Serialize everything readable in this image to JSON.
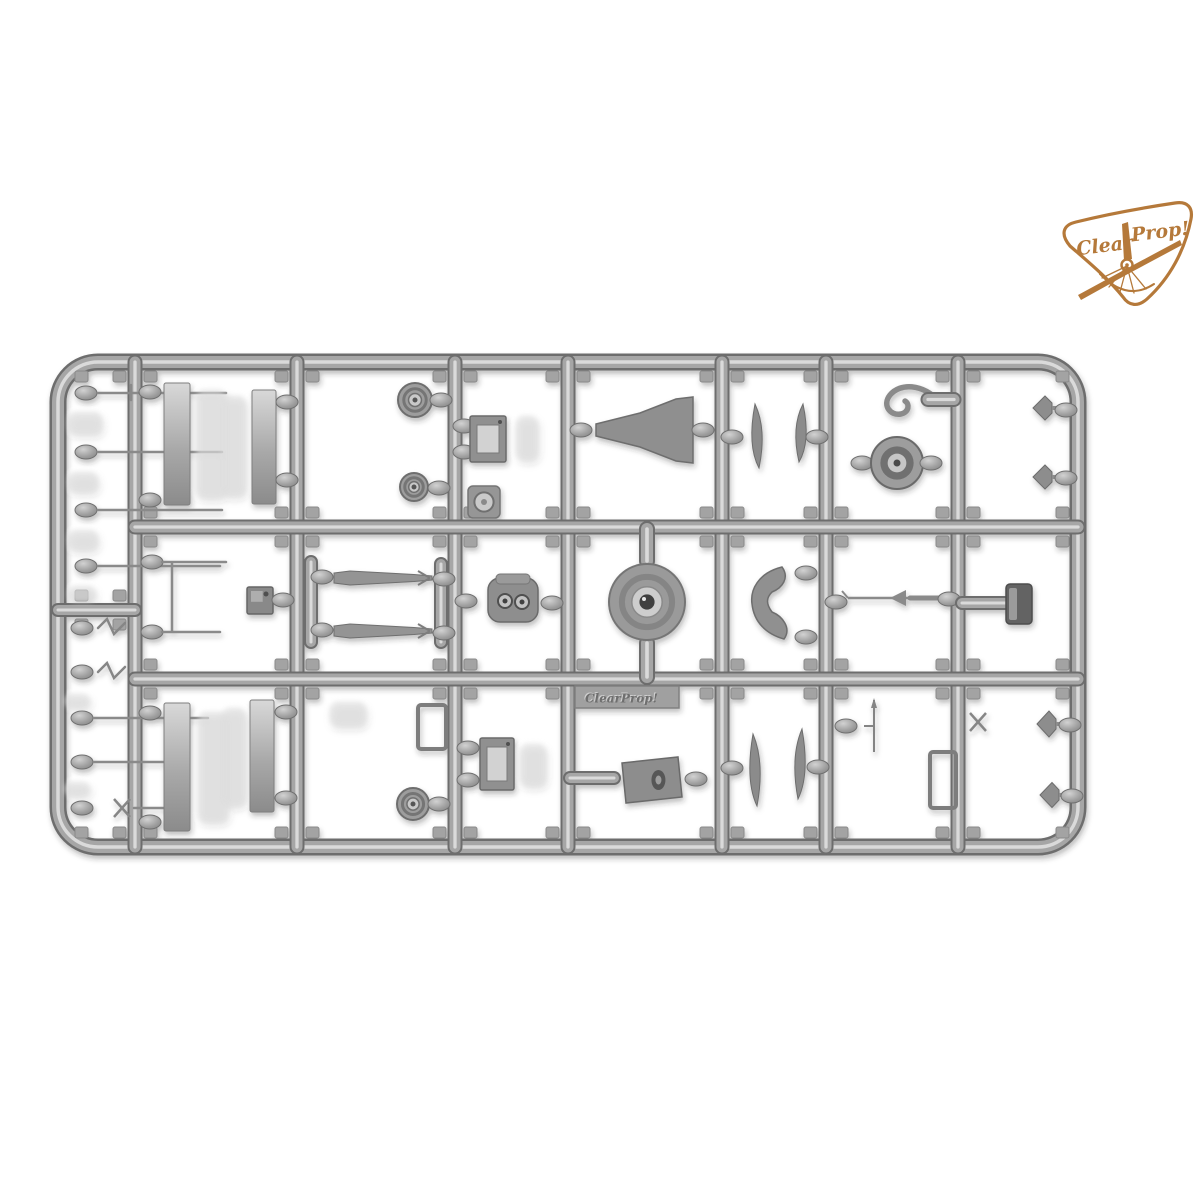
{
  "meta": {
    "background": "#ffffff",
    "description": "product photo of a gray plastic model-kit sprue with small parts, Clear Prop logo top right"
  },
  "logo": {
    "text_left": "Clear",
    "text_right": "Prop!",
    "color": "#b5793a"
  },
  "nameplate": {
    "text": "ClearProp!"
  },
  "palette": {
    "rail_dark": "#6d6d6d",
    "rail_mid": "#a6a6a6",
    "rail_light": "#dadada",
    "part_dark": "#757575",
    "part_mid": "#9a9a9a",
    "part_light": "#cccccc",
    "ghost": "#dedede",
    "tab_fill": "#a3a3a3",
    "tab_stroke": "#8a8a8a"
  },
  "sprue": {
    "frame": {
      "x1": 58,
      "y1": 362,
      "x2": 1078,
      "y2": 847,
      "r": 40
    },
    "v_rails": [
      135,
      297,
      455,
      568,
      722,
      826,
      958
    ],
    "h_rails": [
      527,
      679
    ],
    "strip_divider_y": 610,
    "cols": [
      [
        135,
        297
      ],
      [
        297,
        455
      ],
      [
        455,
        568
      ],
      [
        568,
        722
      ],
      [
        722,
        826
      ],
      [
        826,
        958
      ],
      [
        958,
        1078
      ]
    ],
    "rows": [
      [
        362,
        527
      ],
      [
        527,
        679
      ],
      [
        679,
        847
      ]
    ],
    "strip_col": [
      66,
      135
    ],
    "strip_rows": [
      [
        362,
        610
      ],
      [
        610,
        847
      ]
    ],
    "parts": [
      {
        "t": "gate",
        "x": 86,
        "y": 393
      },
      {
        "t": "pin",
        "x1": 98,
        "y1": 393,
        "x2": 226,
        "y2": 393
      },
      {
        "t": "pin",
        "x1": 131,
        "y1": 385,
        "x2": 131,
        "y2": 400
      },
      {
        "t": "ghost",
        "x": 68,
        "y": 412,
        "w": 34,
        "h": 22
      },
      {
        "t": "gate",
        "x": 86,
        "y": 452
      },
      {
        "t": "pin",
        "x1": 98,
        "y1": 452,
        "x2": 222,
        "y2": 452
      },
      {
        "t": "ghost",
        "x": 68,
        "y": 472,
        "w": 30,
        "h": 20
      },
      {
        "t": "gate",
        "x": 86,
        "y": 510
      },
      {
        "t": "pin",
        "x1": 98,
        "y1": 510,
        "x2": 222,
        "y2": 510
      },
      {
        "t": "ghost",
        "x": 68,
        "y": 530,
        "w": 30,
        "h": 20
      },
      {
        "t": "gate",
        "x": 86,
        "y": 566
      },
      {
        "t": "pin",
        "x1": 98,
        "y1": 566,
        "x2": 220,
        "y2": 566
      },
      {
        "t": "ghost",
        "x": 68,
        "y": 586,
        "w": 28,
        "h": 16
      },
      {
        "t": "gate",
        "x": 82,
        "y": 628
      },
      {
        "t": "zig",
        "x": 98,
        "y": 628
      },
      {
        "t": "gate",
        "x": 82,
        "y": 672
      },
      {
        "t": "zig",
        "x": 98,
        "y": 672
      },
      {
        "t": "gate",
        "x": 82,
        "y": 718
      },
      {
        "t": "pin",
        "x1": 94,
        "y1": 718,
        "x2": 208,
        "y2": 718
      },
      {
        "t": "ghost",
        "x": 64,
        "y": 694,
        "w": 26,
        "h": 14
      },
      {
        "t": "gate",
        "x": 82,
        "y": 762
      },
      {
        "t": "pin",
        "x1": 94,
        "y1": 762,
        "x2": 182,
        "y2": 762
      },
      {
        "t": "ghost",
        "x": 64,
        "y": 782,
        "w": 26,
        "h": 14
      },
      {
        "t": "gate",
        "x": 82,
        "y": 808
      },
      {
        "t": "xpart",
        "x": 122,
        "y": 808
      },
      {
        "t": "pin",
        "x1": 134,
        "y1": 808,
        "x2": 184,
        "y2": 808
      },
      {
        "t": "gate",
        "x": 150,
        "y": 392
      },
      {
        "t": "gate",
        "x": 150,
        "y": 500
      },
      {
        "t": "panel",
        "x": 164,
        "y": 383,
        "w": 26,
        "h": 122
      },
      {
        "t": "ghost",
        "x": 196,
        "y": 390,
        "w": 30,
        "h": 108
      },
      {
        "t": "panel",
        "x": 252,
        "y": 390,
        "w": 24,
        "h": 114
      },
      {
        "t": "gate",
        "x": 287,
        "y": 402
      },
      {
        "t": "gate",
        "x": 287,
        "y": 480
      },
      {
        "t": "ghost",
        "x": 222,
        "y": 396,
        "w": 24,
        "h": 100
      },
      {
        "t": "gate",
        "x": 152,
        "y": 562
      },
      {
        "t": "pin",
        "x1": 162,
        "y1": 562,
        "x2": 226,
        "y2": 562
      },
      {
        "t": "pin",
        "x1": 172,
        "y1": 563,
        "x2": 172,
        "y2": 631
      },
      {
        "t": "gate",
        "x": 152,
        "y": 632
      },
      {
        "t": "pin",
        "x1": 162,
        "y1": 632,
        "x2": 220,
        "y2": 632
      },
      {
        "t": "box",
        "x": 247,
        "y": 587,
        "w": 26,
        "h": 27,
        "v": "dark"
      },
      {
        "t": "gate",
        "x": 283,
        "y": 600
      },
      {
        "t": "gate",
        "x": 150,
        "y": 713
      },
      {
        "t": "gate",
        "x": 150,
        "y": 822
      },
      {
        "t": "panel",
        "x": 164,
        "y": 703,
        "w": 26,
        "h": 128
      },
      {
        "t": "ghost",
        "x": 198,
        "y": 712,
        "w": 30,
        "h": 110
      },
      {
        "t": "panel",
        "x": 250,
        "y": 700,
        "w": 24,
        "h": 112
      },
      {
        "t": "gate",
        "x": 286,
        "y": 712
      },
      {
        "t": "gate",
        "x": 286,
        "y": 798
      },
      {
        "t": "ghost",
        "x": 222,
        "y": 708,
        "w": 24,
        "h": 98
      },
      {
        "t": "wheel",
        "cx": 415,
        "cy": 400,
        "r": 17
      },
      {
        "t": "gate",
        "x": 441,
        "y": 400
      },
      {
        "t": "wheel",
        "cx": 414,
        "cy": 487,
        "r": 14
      },
      {
        "t": "gate",
        "x": 439,
        "y": 488
      },
      {
        "t": "bar",
        "x": 306,
        "y": 562,
        "w": 10,
        "h": 80
      },
      {
        "t": "bar",
        "x": 436,
        "y": 564,
        "w": 10,
        "h": 78
      },
      {
        "t": "gate",
        "x": 322,
        "y": 577
      },
      {
        "t": "strut",
        "x1": 334,
        "x2": 432,
        "y": 578
      },
      {
        "t": "gate",
        "x": 444,
        "y": 579
      },
      {
        "t": "gate",
        "x": 322,
        "y": 630
      },
      {
        "t": "strut",
        "x1": 334,
        "x2": 432,
        "y": 631
      },
      {
        "t": "gate",
        "x": 444,
        "y": 633
      },
      {
        "t": "bracket",
        "x": 418,
        "y": 705,
        "w": 28,
        "h": 44
      },
      {
        "t": "ghost",
        "x": 330,
        "y": 702,
        "w": 36,
        "h": 24
      },
      {
        "t": "wheel",
        "cx": 413,
        "cy": 804,
        "r": 16
      },
      {
        "t": "gate",
        "x": 439,
        "y": 804
      },
      {
        "t": "gate",
        "x": 464,
        "y": 426
      },
      {
        "t": "gate",
        "x": 464,
        "y": 452
      },
      {
        "t": "box",
        "x": 470,
        "y": 416,
        "w": 36,
        "h": 46,
        "v": "open"
      },
      {
        "t": "ghost",
        "x": 516,
        "y": 416,
        "w": 22,
        "h": 44
      },
      {
        "t": "ringsq",
        "x": 468,
        "y": 486,
        "w": 32,
        "h": 32
      },
      {
        "t": "gate",
        "x": 466,
        "y": 601
      },
      {
        "t": "engine",
        "x": 488,
        "y": 578,
        "w": 50,
        "h": 44
      },
      {
        "t": "gate",
        "x": 552,
        "y": 603
      },
      {
        "t": "gate",
        "x": 468,
        "y": 748
      },
      {
        "t": "gate",
        "x": 468,
        "y": 780
      },
      {
        "t": "box",
        "x": 480,
        "y": 738,
        "w": 34,
        "h": 52,
        "v": "open"
      },
      {
        "t": "ghost",
        "x": 520,
        "y": 744,
        "w": 26,
        "h": 42
      },
      {
        "t": "gate",
        "x": 581,
        "y": 430
      },
      {
        "t": "funnel",
        "pts": "596,424 640,413 676,399 693,397 693,463 676,461 640,447 596,436"
      },
      {
        "t": "gate",
        "x": 703,
        "y": 430
      },
      {
        "t": "bar",
        "x": 641,
        "y": 529,
        "w": 12,
        "h": 32
      },
      {
        "t": "bar",
        "x": 641,
        "y": 643,
        "w": 12,
        "h": 34
      },
      {
        "t": "disc",
        "cx": 647,
        "cy": 602,
        "r": 38
      },
      {
        "t": "plate",
        "x": 575,
        "y": 686,
        "w": 104,
        "h": 22
      },
      {
        "t": "bar",
        "x": 570,
        "y": 773,
        "w": 44,
        "h": 10
      },
      {
        "t": "drum",
        "x": 620,
        "y": 757,
        "w": 62,
        "h": 46
      },
      {
        "t": "gate",
        "x": 696,
        "y": 779
      },
      {
        "t": "gate",
        "x": 732,
        "y": 437
      },
      {
        "t": "blade",
        "cx": 755,
        "cy": 436,
        "h": 64,
        "d": 1
      },
      {
        "t": "blade",
        "cx": 803,
        "cy": 433,
        "h": 58,
        "d": -1
      },
      {
        "t": "gate",
        "x": 817,
        "y": 437
      },
      {
        "t": "crescent",
        "cx": 771,
        "cy": 602
      },
      {
        "t": "gate",
        "x": 806,
        "y": 573
      },
      {
        "t": "gate",
        "x": 806,
        "y": 637
      },
      {
        "t": "gate",
        "x": 732,
        "y": 768
      },
      {
        "t": "blade",
        "cx": 753,
        "cy": 770,
        "h": 72,
        "d": 1
      },
      {
        "t": "blade",
        "cx": 802,
        "cy": 764,
        "h": 70,
        "d": -1
      },
      {
        "t": "gate",
        "x": 818,
        "y": 767
      },
      {
        "t": "hook",
        "x": 908,
        "y": 399
      },
      {
        "t": "bar",
        "x": 928,
        "y": 394,
        "w": 26,
        "h": 11
      },
      {
        "t": "gate",
        "x": 862,
        "y": 463
      },
      {
        "t": "wheel",
        "cx": 897,
        "cy": 463,
        "r": 26,
        "v": "tire"
      },
      {
        "t": "gate",
        "x": 931,
        "y": 463
      },
      {
        "t": "gate",
        "x": 836,
        "y": 602
      },
      {
        "t": "rod",
        "x1": 848,
        "x2": 944,
        "y": 598
      },
      {
        "t": "gate",
        "x": 949,
        "y": 599
      },
      {
        "t": "gate",
        "x": 846,
        "y": 726
      },
      {
        "t": "needle",
        "x": 874,
        "y": 700
      },
      {
        "t": "bracket",
        "x": 930,
        "y": 752,
        "w": 26,
        "h": 56
      },
      {
        "t": "cone",
        "cx": 1046,
        "cy": 408,
        "s": 24
      },
      {
        "t": "gate",
        "x": 1066,
        "y": 410
      },
      {
        "t": "cone",
        "cx": 1046,
        "cy": 477,
        "s": 24
      },
      {
        "t": "gate",
        "x": 1066,
        "y": 478
      },
      {
        "t": "bar",
        "x": 962,
        "y": 598,
        "w": 46,
        "h": 10
      },
      {
        "t": "seat",
        "x": 1006,
        "y": 584,
        "w": 26,
        "h": 40
      },
      {
        "t": "xpart",
        "x": 978,
        "y": 722
      },
      {
        "t": "cone",
        "cx": 1050,
        "cy": 724,
        "s": 26
      },
      {
        "t": "gate",
        "x": 1070,
        "y": 725
      },
      {
        "t": "cone",
        "cx": 1053,
        "cy": 795,
        "s": 25
      },
      {
        "t": "gate",
        "x": 1072,
        "y": 796
      }
    ]
  }
}
